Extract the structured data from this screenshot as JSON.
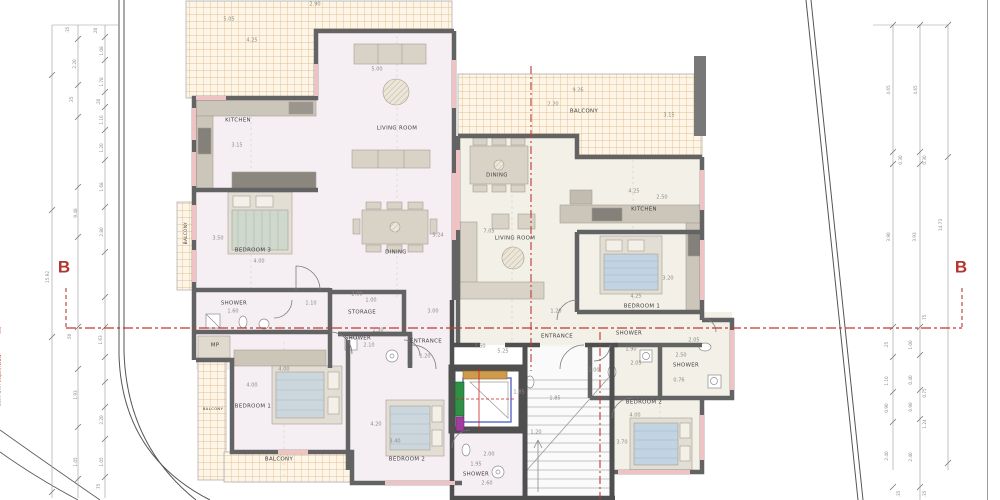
{
  "document": {
    "kind": "architectural floor plan",
    "units": [
      "apartment A (left)",
      "apartment B (right)"
    ],
    "section_line": "B - B"
  },
  "colors": {
    "wall": "#636363",
    "core_wall": "#4f4f4f",
    "window_pink": "#efc3c3",
    "balcony_hatch": "#d9ab6e",
    "floor_a": "#f5eff4",
    "floor_b": "#f2f0e7",
    "section_red": "#c0392f",
    "dim_gray": "#8a8a8a",
    "elevator_green": "#2f8f45",
    "elevator_purple": "#a23b9e",
    "elevator_orange": "#cf9a4b",
    "elevator_blue": "#5b67c7"
  },
  "annotations": {
    "room_labels": [
      {
        "t": "KITCHEN",
        "x": 238,
        "y": 121
      },
      {
        "t": "LIVING ROOM",
        "x": 397,
        "y": 129
      },
      {
        "t": "DINING",
        "x": 396,
        "y": 253
      },
      {
        "t": "BEDROOM 3",
        "x": 253,
        "y": 251
      },
      {
        "t": "SHOWER",
        "x": 234,
        "y": 304
      },
      {
        "t": "STORAGE",
        "x": 362,
        "y": 313
      },
      {
        "t": "SHOWER",
        "x": 358,
        "y": 339
      },
      {
        "t": "ENTRANCE",
        "x": 426,
        "y": 342
      },
      {
        "t": "MP",
        "x": 215,
        "y": 346
      },
      {
        "t": "BEDROOM 1",
        "x": 253,
        "y": 407
      },
      {
        "t": "BALCONY",
        "x": 213,
        "y": 409,
        "s": 3.8
      },
      {
        "t": "BALCONY",
        "x": 279,
        "y": 460
      },
      {
        "t": "BEDROOM 2",
        "x": 407,
        "y": 460
      },
      {
        "t": "SHOWER",
        "x": 476,
        "y": 475
      },
      {
        "t": "BALCONY",
        "x": 186,
        "y": 233,
        "r": -90,
        "s": 4.2
      },
      {
        "t": "BALCONY",
        "x": 584,
        "y": 112
      },
      {
        "t": "DINING",
        "x": 497,
        "y": 176
      },
      {
        "t": "LIVING ROOM",
        "x": 515,
        "y": 239
      },
      {
        "t": "KITCHEN",
        "x": 644,
        "y": 210
      },
      {
        "t": "BEDROOM 1",
        "x": 642,
        "y": 307
      },
      {
        "t": "ENTRANCE",
        "x": 557,
        "y": 337
      },
      {
        "t": "SHOWER",
        "x": 629,
        "y": 334
      },
      {
        "t": "SHOWER",
        "x": 686,
        "y": 366
      },
      {
        "t": "BEDROOM 2",
        "x": 644,
        "y": 403
      }
    ],
    "dim_labels": [
      {
        "t": "5.05",
        "x": 229,
        "y": 20
      },
      {
        "t": "4.25",
        "x": 252,
        "y": 41
      },
      {
        "t": "2.90",
        "x": 315,
        "y": 5
      },
      {
        "t": "5.00",
        "x": 377,
        "y": 70
      },
      {
        "t": "3.15",
        "x": 237,
        "y": 146
      },
      {
        "t": "5.24",
        "x": 438,
        "y": 236
      },
      {
        "t": "3.50",
        "x": 218,
        "y": 239
      },
      {
        "t": "4.00",
        "x": 259,
        "y": 262
      },
      {
        "t": "1.60",
        "x": 233,
        "y": 312
      },
      {
        "t": "1.10",
        "x": 311,
        "y": 304
      },
      {
        "t": "2.00",
        "x": 357,
        "y": 295
      },
      {
        "t": "1.00",
        "x": 371,
        "y": 301
      },
      {
        "t": "3.00",
        "x": 433,
        "y": 312
      },
      {
        "t": "1.30",
        "x": 378,
        "y": 331
      },
      {
        "t": "2.10",
        "x": 369,
        "y": 346
      },
      {
        "t": "1.20",
        "x": 425,
        "y": 357
      },
      {
        "t": "4.00",
        "x": 284,
        "y": 370
      },
      {
        "t": "4.00",
        "x": 252,
        "y": 386
      },
      {
        "t": "4.20",
        "x": 376,
        "y": 425
      },
      {
        "t": "3.40",
        "x": 395,
        "y": 442
      },
      {
        "t": "2.00",
        "x": 489,
        "y": 455
      },
      {
        "t": "1.95",
        "x": 476,
        "y": 465
      },
      {
        "t": "2.60",
        "x": 487,
        "y": 484
      },
      {
        "t": "1.85",
        "x": 519,
        "y": 393
      },
      {
        "t": "1.85",
        "x": 555,
        "y": 399
      },
      {
        "t": "1.20",
        "x": 536,
        "y": 433
      },
      {
        "t": "1.50",
        "x": 480,
        "y": 347
      },
      {
        "t": "5.25",
        "x": 503,
        "y": 352
      },
      {
        "t": "9.26",
        "x": 578,
        "y": 91
      },
      {
        "t": "2.20",
        "x": 553,
        "y": 105
      },
      {
        "t": "3.15",
        "x": 669,
        "y": 116
      },
      {
        "t": "7.05",
        "x": 489,
        "y": 232
      },
      {
        "t": "4.25",
        "x": 634,
        "y": 192
      },
      {
        "t": "2.50",
        "x": 662,
        "y": 198
      },
      {
        "t": "3.20",
        "x": 668,
        "y": 279
      },
      {
        "t": "4.25",
        "x": 636,
        "y": 297
      },
      {
        "t": "1.20",
        "x": 556,
        "y": 312
      },
      {
        "t": "1.00",
        "x": 594,
        "y": 371
      },
      {
        "t": "1.90",
        "x": 631,
        "y": 350
      },
      {
        "t": "2.05",
        "x": 636,
        "y": 364
      },
      {
        "t": "2.05",
        "x": 694,
        "y": 341
      },
      {
        "t": "2.50",
        "x": 681,
        "y": 356
      },
      {
        "t": "0.76",
        "x": 679,
        "y": 381
      },
      {
        "t": "4.00",
        "x": 635,
        "y": 416
      },
      {
        "t": "3.70",
        "x": 622,
        "y": 443
      }
    ],
    "side_dims_left": [
      {
        "t": ".35",
        "x": 68,
        "y": 30,
        "r": -90
      },
      {
        "t": ".20",
        "x": 96,
        "y": 31,
        "r": -90
      },
      {
        "t": "2.20",
        "x": 75,
        "y": 64,
        "r": -90
      },
      {
        "t": "1.08",
        "x": 102,
        "y": 51,
        "r": -90
      },
      {
        "t": "1.78",
        "x": 102,
        "y": 82,
        "r": -90
      },
      {
        "t": ".35",
        "x": 72,
        "y": 100,
        "r": -90
      },
      {
        "t": ".20",
        "x": 99,
        "y": 102,
        "r": -90
      },
      {
        "t": "1.16",
        "x": 102,
        "y": 120,
        "r": -90
      },
      {
        "t": "1.20",
        "x": 102,
        "y": 148,
        "r": -90
      },
      {
        "t": "1.68",
        "x": 102,
        "y": 187,
        "r": -90
      },
      {
        "t": "9.48",
        "x": 76,
        "y": 213,
        "r": -90
      },
      {
        "t": "2.80",
        "x": 102,
        "y": 232,
        "r": -90
      },
      {
        "t": "15.92",
        "x": 48,
        "y": 277,
        "r": -90
      },
      {
        "t": ".50",
        "x": 70,
        "y": 337,
        "r": -90
      },
      {
        "t": "1.63",
        "x": 101,
        "y": 340,
        "r": -90
      },
      {
        "t": "1.93",
        "x": 76,
        "y": 395,
        "r": -90
      },
      {
        "t": "2.20",
        "x": 102,
        "y": 420,
        "r": -90
      },
      {
        "t": "1.05",
        "x": 76,
        "y": 462,
        "r": -90
      },
      {
        "t": "1.05",
        "x": 102,
        "y": 462,
        "r": -90
      },
      {
        "t": ".75",
        "x": 99,
        "y": 487,
        "r": -90
      }
    ],
    "side_dims_right": [
      {
        "t": "4.65",
        "x": 889,
        "y": 90,
        "r": -90
      },
      {
        "t": "4.65",
        "x": 916,
        "y": 90,
        "r": -90
      },
      {
        "t": "0.30",
        "x": 901,
        "y": 160,
        "r": -90
      },
      {
        "t": "0.30",
        "x": 925,
        "y": 160,
        "r": -90
      },
      {
        "t": "3.90",
        "x": 889,
        "y": 237,
        "r": -90
      },
      {
        "t": "3.93",
        "x": 915,
        "y": 237,
        "r": -90
      },
      {
        "t": "14.73",
        "x": 941,
        "y": 225,
        "r": -90
      },
      {
        "t": ".75",
        "x": 925,
        "y": 318,
        "r": -90
      },
      {
        "t": ".25",
        "x": 887,
        "y": 345,
        "r": -90
      },
      {
        "t": "1.00",
        "x": 911,
        "y": 345,
        "r": -90
      },
      {
        "t": "1.10",
        "x": 887,
        "y": 381,
        "r": -90
      },
      {
        "t": "0.40",
        "x": 911,
        "y": 380,
        "r": -90
      },
      {
        "t": "0.75",
        "x": 925,
        "y": 393,
        "r": -90
      },
      {
        "t": "0.90",
        "x": 887,
        "y": 408,
        "r": -90
      },
      {
        "t": "0.90",
        "x": 911,
        "y": 407,
        "r": -90
      },
      {
        "t": "1.24",
        "x": 925,
        "y": 424,
        "r": -90
      },
      {
        "t": "2.40",
        "x": 887,
        "y": 456,
        "r": -90
      },
      {
        "t": "2.40",
        "x": 911,
        "y": 457,
        "r": -90
      },
      {
        "t": ".35",
        "x": 899,
        "y": 494,
        "r": -90
      },
      {
        "t": ".35",
        "x": 925,
        "y": 494,
        "r": -90
      }
    ],
    "section_markers": [
      {
        "t": "B",
        "x": 64,
        "y": 267
      },
      {
        "t": "B",
        "x": 961,
        "y": 267
      }
    ],
    "titleblock_fragments": [
      {
        "t": "A",
        "x": 994,
        "y": 347
      },
      {
        "t": "S",
        "x": 994,
        "y": 356
      },
      {
        "t": "T",
        "x": 994,
        "y": 372
      },
      {
        "t": "E",
        "x": 994,
        "y": 380
      },
      {
        "t": "O",
        "x": 994,
        "y": 398
      },
      {
        "t": "P",
        "x": 994,
        "y": 428
      },
      {
        "t": "D",
        "x": 994,
        "y": 453
      },
      {
        "t": "1",
        "x": 994,
        "y": 462,
        "c": "#c0392f"
      },
      {
        "t": "L",
        "x": 994,
        "y": 483
      }
    ]
  },
  "watermark": {
    "prefix": "built with  ",
    "url": "https://www.********.eu"
  }
}
